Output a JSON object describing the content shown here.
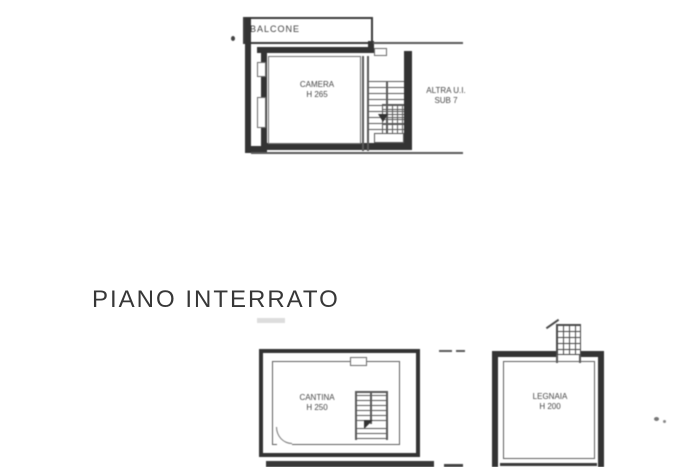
{
  "page": {
    "background": "#ffffff"
  },
  "colors": {
    "wall": "#333333",
    "thin_line": "#5a5a5a",
    "label_text": "#454545",
    "heading_text": "#373737"
  },
  "heading": {
    "title": "PIANO INTERRATO"
  },
  "upper_plan": {
    "balcony_label": "BALCONE",
    "camera": {
      "name": "CAMERA",
      "height": "H 265"
    },
    "altra": {
      "line1": "ALTRA U.I.",
      "line2": "SUB 7"
    }
  },
  "lower_plan": {
    "cantina": {
      "name": "CANTINA",
      "height": "H 250"
    },
    "legnaia": {
      "name": "LEGNAIA",
      "height": "H 200"
    }
  }
}
